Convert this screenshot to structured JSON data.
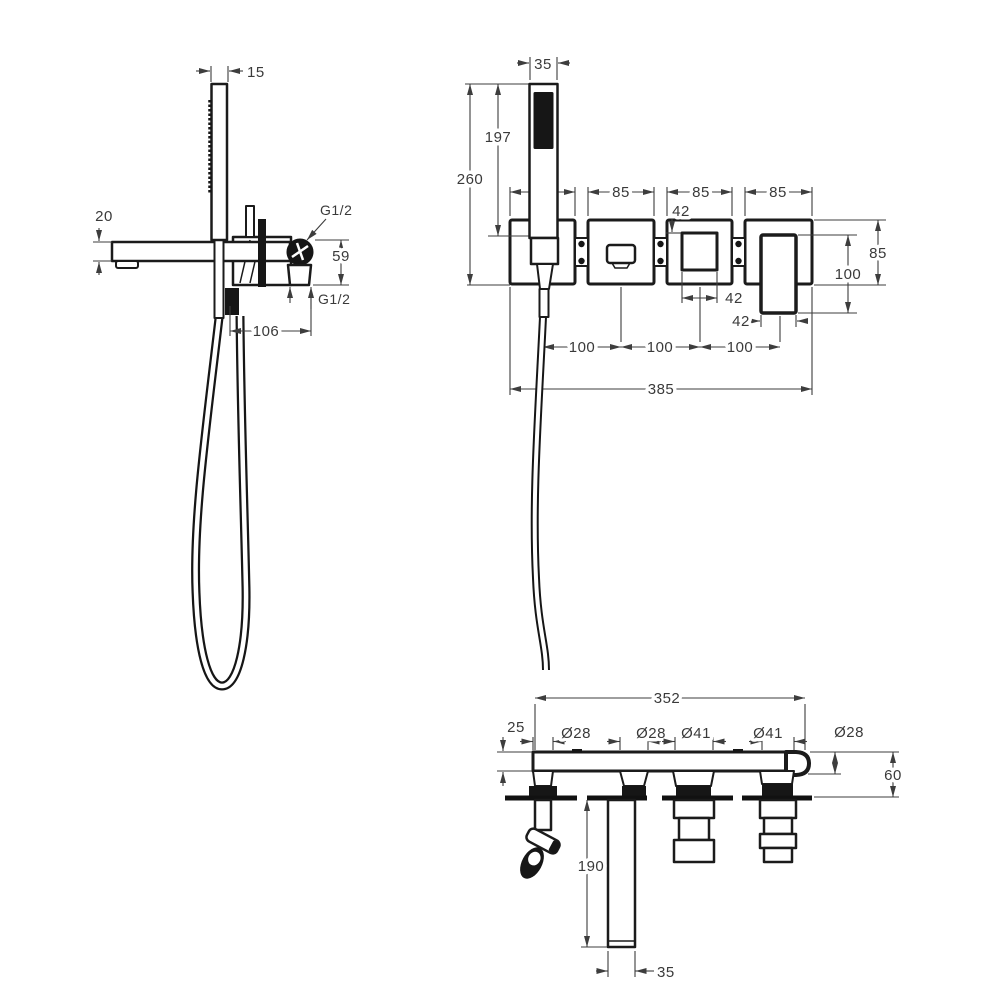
{
  "page": {
    "background": "#ffffff",
    "line_color": "#1b1b1b",
    "text_color": "#3a3a3a"
  },
  "drawing": {
    "side_view": {
      "dims": {
        "hand_shower_thickness": "15",
        "spout_height": "20",
        "thread_size_top": "G1/2",
        "body_height": "59",
        "thread_size_bottom": "G1/2",
        "spout_projection": "106"
      }
    },
    "front_view": {
      "dims": {
        "hand_shower_width": "35",
        "hand_shower_length": "197",
        "overall_height": "260",
        "plate1_width": "85",
        "plate2_width": "85",
        "plate3_width": "85",
        "plate4_width": "85",
        "diverter_height": "42",
        "diverter_width": "42",
        "handle_lever_width": "42",
        "plate_height": "85",
        "handle_height": "100",
        "spacing_1": "100",
        "spacing_2": "100",
        "spacing_3": "100",
        "overall_width": "385"
      }
    },
    "plan_view": {
      "dims": {
        "overall_width": "352",
        "plate_thickness": "25",
        "holder_diameter": "Ø28",
        "spout_diameter": "Ø28",
        "diverter_diameter": "Ø41",
        "cartridge_diameter": "Ø41",
        "outlet_diameter": "Ø28",
        "wall_depth": "60",
        "spout_length": "190",
        "spout_end_width": "35"
      }
    }
  }
}
